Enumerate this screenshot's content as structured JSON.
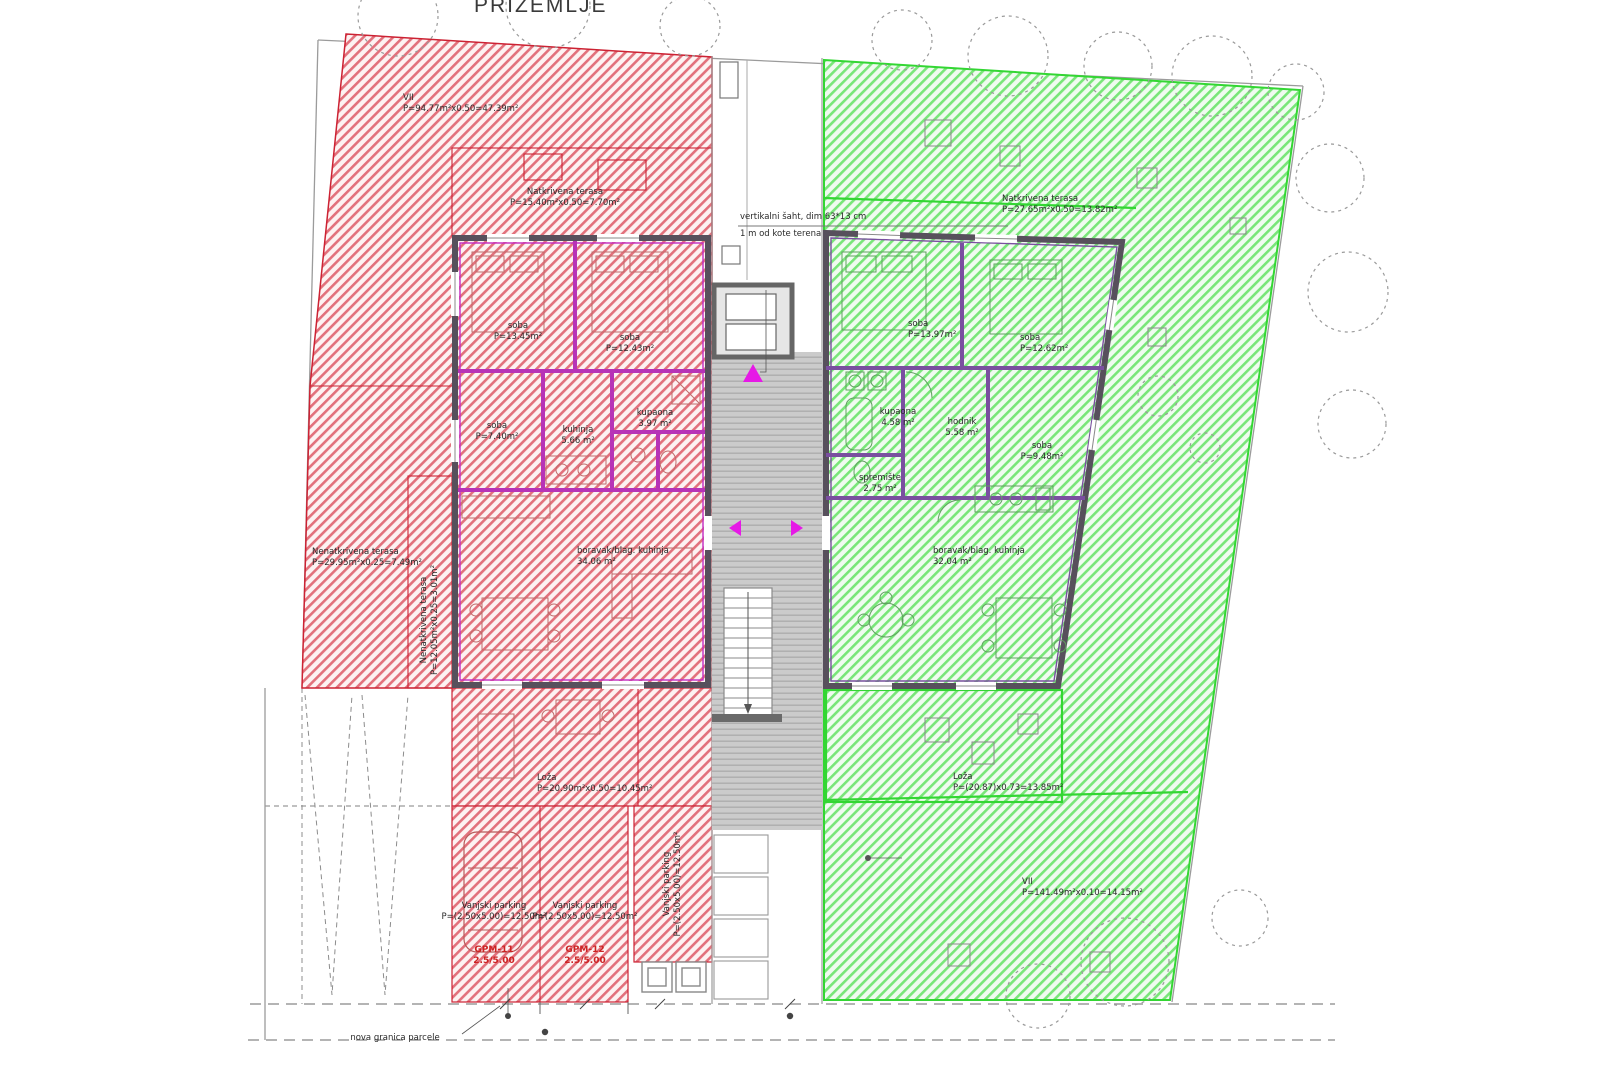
{
  "title": "PRIZEMLJE",
  "annotations": {
    "shaft_note_line1": "vertikalni šaht, dim 63*13 cm",
    "shaft_note_line2": "1 m od kote terena",
    "parcel_note": "nova granica parcele"
  },
  "red_unit": {
    "site": {
      "name": "VII",
      "area": "P=94.77m²x0.50=47.39m²"
    },
    "covered_terrace": {
      "name": "Natkrivena terasa",
      "area": "P=15.40m²x0.50=7.70m²"
    },
    "uncovered_terrace": {
      "name": "Nenatkrivena terasa",
      "area": "P=29.95m²x0.25=7.49m²"
    },
    "side_terrace": {
      "name": "Nenatkrivena terasa",
      "area": "P=12.05m²x0.25=3.01m²"
    },
    "rooms": [
      {
        "name": "soba",
        "area": "P=13.45m²"
      },
      {
        "name": "soba",
        "area": "P=12.43m²"
      },
      {
        "name": "soba",
        "area": "P=7.40m²"
      },
      {
        "name": "kuhinja",
        "area": "5.66 m²"
      },
      {
        "name": "kupaona",
        "area": "3.97 m²"
      },
      {
        "name": "boravak/blag. kuhinja",
        "area": "34.06 m²"
      }
    ],
    "loggia": {
      "name": "Loža",
      "area": "P=20.90m²x0.50=10.45m²"
    },
    "parking_stalls": [
      {
        "name": "Vanjski parking",
        "calc": "P=(2.50x5.00)=12.50m²",
        "code": "GPM-11",
        "size": "2.5/5.00"
      },
      {
        "name": "Vanjski parking",
        "calc": "P=(2.50x5.00)=12.50m²",
        "code": "GPM-12",
        "size": "2.5/5.00"
      },
      {
        "name": "Vanjski parking",
        "calc": "P=(2.50x5.00)=12.50m²"
      }
    ]
  },
  "green_unit": {
    "covered_terrace": {
      "name": "Natkrivena terasa",
      "area": "P=27.65m²x0.50=13.82m²"
    },
    "rooms": [
      {
        "name": "soba",
        "area": "P=13.97m²"
      },
      {
        "name": "soba",
        "area": "P=12.62m²"
      },
      {
        "name": "kupaona",
        "area": "4.58 m²"
      },
      {
        "name": "hodnik",
        "area": "5.58 m²"
      },
      {
        "name": "soba",
        "area": "P=9.48m²"
      },
      {
        "name": "spremište",
        "area": "2.75 m²"
      },
      {
        "name": "boravak/blag. kuhinja",
        "area": "32.04 m²"
      }
    ],
    "loggia": {
      "name": "Loža",
      "area": "P=(20.87)x0.73=13.85m²"
    },
    "garden": {
      "name": "VII",
      "area": "P=141.49m²x0.10=14.15m²"
    }
  },
  "colors": {
    "red_zone_border": "#cc2233",
    "red_hatch": "#e2717c",
    "green_zone_border": "#33d633",
    "green_hatch": "#79e679",
    "wall": "#57505c",
    "red_wall_accent": "#c32cc3",
    "green_wall_accent": "#7a4fa0",
    "entry_marker": "#e619e6",
    "walkway": "#cccccc"
  }
}
